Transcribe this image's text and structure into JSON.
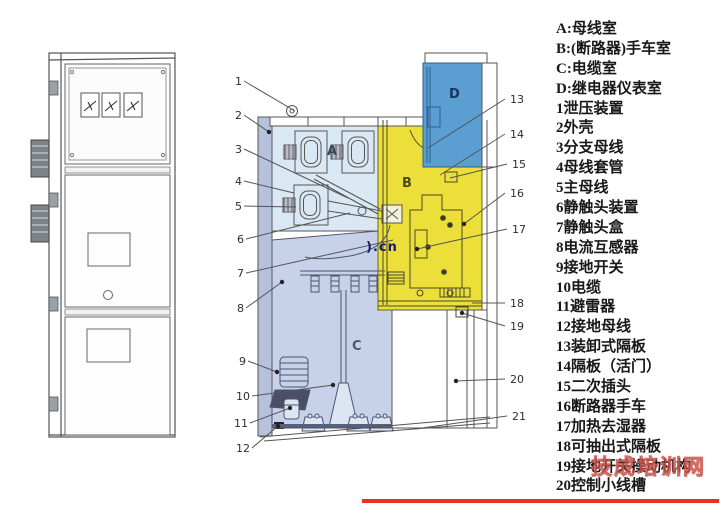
{
  "legend": {
    "items": [
      "A:母线室",
      "B:(断路器)手车室",
      "C:电缆室",
      "D:继电器仪表室",
      "1泄压装置",
      "2外壳",
      "3分支母线",
      "4母线套管",
      "5主母线",
      "6静触头装置",
      "7静触头盒",
      "8电流互感器",
      "9接地开关",
      "10电缆",
      "11避雷器",
      "12接地母线",
      "13装卸式隔板",
      "14隔板（活门）",
      "15二次插头",
      "16断路器手车",
      "17加热去湿器",
      "18可抽出式隔板",
      "19接地开关操动机构",
      "20控制小线槽"
    ]
  },
  "watermarks": {
    "cn_text": ").cn",
    "brand_text": "技成培训网",
    "brand_color": "#cf6b63",
    "underline_color": "#e63226"
  },
  "diagram": {
    "compartment_labels": {
      "a": "A",
      "b": "B",
      "c": "C",
      "d": "D"
    },
    "callouts": {
      "left": [
        "1",
        "2",
        "3",
        "4",
        "5",
        "6",
        "7",
        "8",
        "9",
        "10",
        "11",
        "12"
      ],
      "right": [
        "13",
        "14",
        "15",
        "16",
        "17",
        "18",
        "19",
        "20",
        "21"
      ]
    },
    "colors": {
      "busbar_room": "#d9e8f3",
      "breaker_room": "#ecdf3a",
      "cable_room": "#c7d2ea",
      "relay_room": "#5b9ed2",
      "shell": "#b6c1dc",
      "compartment_white": "#ffffff"
    }
  }
}
